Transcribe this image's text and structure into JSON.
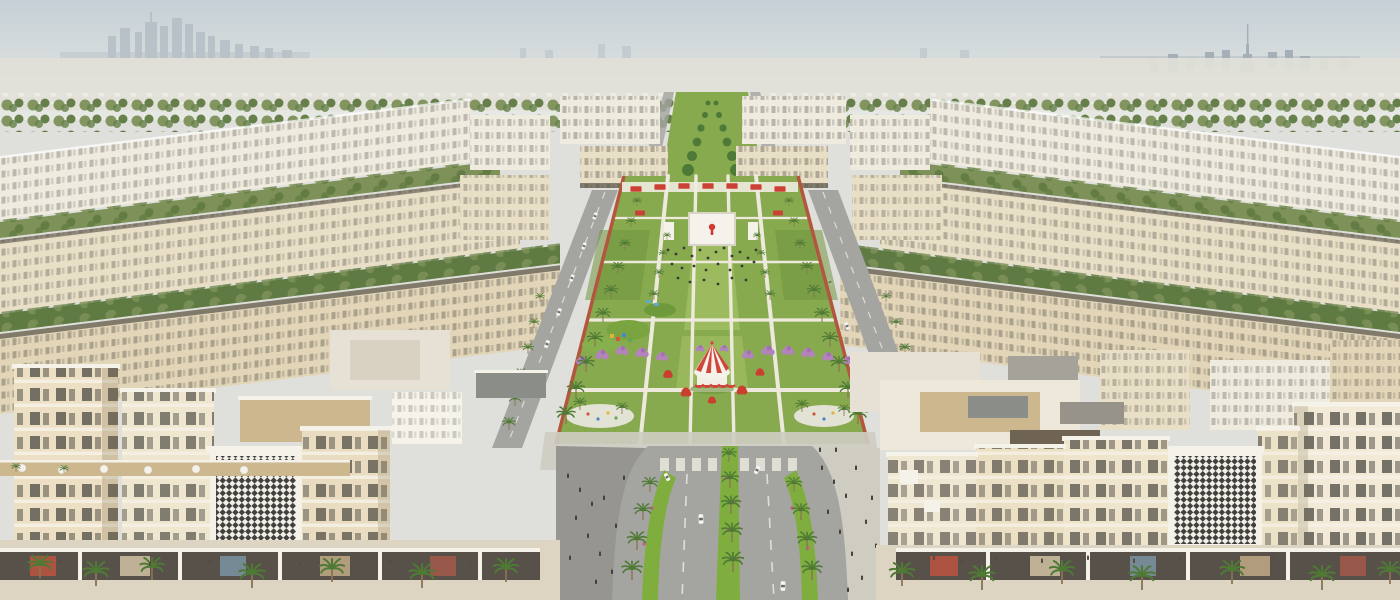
{
  "scene": {
    "description": "Aerial rendering of a symmetric master-planned desert community: cream mid-rise apartment blocks around a large central park with lawns, palm rows, a giant event screen with a red logo, a red-and-white circus tent, purple blossom groves, playgrounds, a palm-lined avenue forking at the foreground, retail podiums with black-and-white mashrabiya facade panels, and hazy city skylines with a tall spire tower on the horizon.",
    "time_of_day": "day, hazy sunlight",
    "landmarks": [
      "distant-skyline-left",
      "distant-spire-tower-right",
      "central-event-screen",
      "circus-tent",
      "purple-blossom-grove",
      "mashrabiya-facade-panels",
      "palm-lined-avenue",
      "central-park-lawns",
      "jogging-track"
    ],
    "decor": [
      {
        "symbol": "sym-palm",
        "layer": "palms-park-left",
        "items": [
          [
            566,
            424,
            1
          ],
          [
            576,
            398,
            0.95
          ],
          [
            586,
            372,
            0.9
          ],
          [
            595,
            347,
            0.85
          ],
          [
            603,
            322,
            0.8
          ],
          [
            611,
            298,
            0.74
          ],
          [
            618,
            274,
            0.68
          ],
          [
            625,
            250,
            0.6
          ],
          [
            631,
            227,
            0.54
          ],
          [
            637,
            206,
            0.48
          ]
        ]
      },
      {
        "symbol": "sym-palm",
        "layer": "palms-park-right",
        "items": [
          [
            858,
            424,
            1
          ],
          [
            848,
            398,
            0.95
          ],
          [
            839,
            372,
            0.9
          ],
          [
            830,
            347,
            0.85
          ],
          [
            822,
            322,
            0.8
          ],
          [
            814,
            298,
            0.74
          ],
          [
            807,
            274,
            0.68
          ],
          [
            800,
            250,
            0.6
          ],
          [
            794,
            227,
            0.54
          ],
          [
            789,
            206,
            0.48
          ]
        ]
      },
      {
        "symbol": "sym-palm",
        "layer": "palms-park-inner",
        "items": [
          [
            654,
            300,
            0.55
          ],
          [
            659,
            278,
            0.5
          ],
          [
            663,
            258,
            0.46
          ],
          [
            667,
            240,
            0.42
          ],
          [
            770,
            300,
            0.55
          ],
          [
            765,
            278,
            0.5
          ],
          [
            761,
            258,
            0.46
          ],
          [
            757,
            240,
            0.42
          ],
          [
            580,
            410,
            0.7
          ],
          [
            622,
            414,
            0.65
          ],
          [
            802,
            412,
            0.7
          ],
          [
            844,
            416,
            0.65
          ]
        ]
      },
      {
        "symbol": "sym-palm",
        "layer": "palms-median",
        "items": [
          [
            729,
            462,
            0.8
          ],
          [
            730,
            488,
            0.95
          ],
          [
            731,
            514,
            1.05
          ],
          [
            732,
            542,
            1.1
          ],
          [
            733,
            572,
            1.15
          ],
          [
            650,
            492,
            0.85
          ],
          [
            643,
            520,
            0.95
          ],
          [
            637,
            550,
            1.05
          ],
          [
            632,
            580,
            1.1
          ],
          [
            794,
            492,
            0.85
          ],
          [
            801,
            520,
            0.95
          ],
          [
            807,
            550,
            1.05
          ],
          [
            812,
            580,
            1.1
          ]
        ]
      },
      {
        "symbol": "sym-palm",
        "layer": "palms-street-left",
        "items": [
          [
            540,
            302,
            0.5
          ],
          [
            534,
            328,
            0.55
          ],
          [
            528,
            354,
            0.6
          ],
          [
            521,
            380,
            0.65
          ],
          [
            515,
            406,
            0.7
          ],
          [
            509,
            430,
            0.72
          ]
        ]
      },
      {
        "symbol": "sym-palm",
        "layer": "palms-street-right",
        "items": [
          [
            886,
            302,
            0.5
          ],
          [
            896,
            328,
            0.55
          ],
          [
            905,
            354,
            0.6
          ],
          [
            915,
            380,
            0.65
          ],
          [
            925,
            406,
            0.7
          ],
          [
            934,
            430,
            0.72
          ]
        ]
      },
      {
        "symbol": "sym-palm",
        "layer": "palms-front-left",
        "items": [
          [
            40,
            578,
            1.3
          ],
          [
            96,
            586,
            1.4
          ],
          [
            152,
            580,
            1.3
          ],
          [
            252,
            588,
            1.4
          ],
          [
            332,
            582,
            1.35
          ],
          [
            422,
            588,
            1.4
          ],
          [
            506,
            582,
            1.35
          ],
          [
            16,
            472,
            0.5
          ],
          [
            64,
            474,
            0.5
          ]
        ]
      },
      {
        "symbol": "sym-palm",
        "layer": "palms-front-right",
        "items": [
          [
            902,
            586,
            1.35
          ],
          [
            982,
            590,
            1.4
          ],
          [
            1062,
            584,
            1.35
          ],
          [
            1142,
            590,
            1.4
          ],
          [
            1232,
            584,
            1.35
          ],
          [
            1322,
            590,
            1.4
          ],
          [
            1390,
            584,
            1.3
          ]
        ]
      },
      {
        "symbol": "sym-tree",
        "layer": "boulevard-trees",
        "fill": "#4e7a38",
        "items": [
          [
            688,
            170,
            0.85
          ],
          [
            736,
            170,
            0.85
          ],
          [
            692,
            156,
            0.72
          ],
          [
            732,
            156,
            0.72
          ],
          [
            697,
            142,
            0.62
          ],
          [
            727,
            142,
            0.62
          ],
          [
            701,
            128,
            0.52
          ],
          [
            723,
            128,
            0.52
          ],
          [
            705,
            115,
            0.44
          ],
          [
            719,
            115,
            0.44
          ],
          [
            708,
            103,
            0.36
          ],
          [
            716,
            103,
            0.36
          ]
        ]
      },
      {
        "symbol": "sym-ptree",
        "layer": "purple-grove",
        "items": [
          [
            582,
            360,
            0.8
          ],
          [
            602,
            354,
            0.9
          ],
          [
            622,
            350,
            0.85
          ],
          [
            642,
            352,
            0.9
          ],
          [
            662,
            356,
            0.8
          ],
          [
            700,
            348,
            0.6
          ],
          [
            724,
            348,
            0.6
          ],
          [
            748,
            354,
            0.8
          ],
          [
            768,
            350,
            0.9
          ],
          [
            788,
            350,
            0.85
          ],
          [
            808,
            352,
            0.9
          ],
          [
            828,
            356,
            0.8
          ],
          [
            848,
            360,
            0.75
          ]
        ]
      },
      {
        "symbol": "sym-rtree",
        "layer": "red-grove",
        "items": [
          [
            668,
            374,
            0.8
          ],
          [
            686,
            392,
            0.9
          ],
          [
            742,
            390,
            0.9
          ],
          [
            760,
            372,
            0.75
          ],
          [
            712,
            400,
            0.7
          ]
        ]
      },
      {
        "symbol": "sym-canopy",
        "layer": "red-canopies",
        "fill": "#cc4136",
        "items": [
          [
            636,
            189,
            0.8
          ],
          [
            660,
            187,
            0.8
          ],
          [
            684,
            186,
            0.8
          ],
          [
            708,
            186,
            0.8
          ],
          [
            732,
            186,
            0.8
          ],
          [
            756,
            187,
            0.8
          ],
          [
            780,
            189,
            0.8
          ],
          [
            640,
            213,
            0.7
          ],
          [
            778,
            213,
            0.7
          ]
        ]
      },
      {
        "symbol": "sym-dot",
        "layer": "event-crowd",
        "fill": "#3c3a36",
        "items": [
          [
            668,
            250
          ],
          [
            676,
            254
          ],
          [
            684,
            248
          ],
          [
            692,
            256
          ],
          [
            700,
            250
          ],
          [
            708,
            258
          ],
          [
            716,
            252
          ],
          [
            724,
            248
          ],
          [
            732,
            256
          ],
          [
            740,
            252
          ],
          [
            748,
            258
          ],
          [
            756,
            250
          ],
          [
            672,
            264
          ],
          [
            682,
            268
          ],
          [
            694,
            266
          ],
          [
            706,
            270
          ],
          [
            718,
            264
          ],
          [
            730,
            270
          ],
          [
            742,
            266
          ],
          [
            754,
            262
          ],
          [
            678,
            278
          ],
          [
            690,
            282
          ],
          [
            704,
            280
          ],
          [
            718,
            284
          ],
          [
            732,
            278
          ],
          [
            746,
            280
          ]
        ]
      },
      {
        "symbol": "sym-person",
        "layer": "plaza-people-left",
        "fill": "#44413c",
        "items": [
          [
            568,
            478
          ],
          [
            580,
            492
          ],
          [
            592,
            506
          ],
          [
            576,
            520
          ],
          [
            588,
            538
          ],
          [
            600,
            556
          ],
          [
            612,
            574
          ],
          [
            570,
            560
          ],
          [
            604,
            500
          ],
          [
            616,
            528
          ],
          [
            624,
            480
          ],
          [
            596,
            584
          ]
        ]
      },
      {
        "symbol": "sym-person",
        "layer": "plaza-people-right",
        "fill": "#44413c",
        "items": [
          [
            822,
            470
          ],
          [
            834,
            484
          ],
          [
            846,
            498
          ],
          [
            828,
            514
          ],
          [
            840,
            534
          ],
          [
            852,
            556
          ],
          [
            862,
            580
          ],
          [
            872,
            500
          ],
          [
            856,
            470
          ],
          [
            866,
            524
          ],
          [
            876,
            548
          ],
          [
            848,
            592
          ],
          [
            820,
            452
          ],
          [
            836,
            452
          ]
        ]
      },
      {
        "symbol": "sym-person",
        "layer": "arcade-people",
        "fill": "#5a4a42",
        "items": [
          [
            906,
            562
          ],
          [
            934,
            560
          ],
          [
            962,
            564
          ],
          [
            996,
            561
          ],
          [
            1042,
            563
          ],
          [
            1088,
            560
          ],
          [
            1134,
            563
          ],
          [
            1180,
            561
          ],
          [
            1226,
            563
          ],
          [
            1272,
            560
          ],
          [
            150,
            566
          ],
          [
            210,
            564
          ],
          [
            300,
            566
          ],
          [
            390,
            564
          ],
          [
            470,
            566
          ],
          [
            60,
            564
          ]
        ]
      },
      {
        "symbol": "sym-car",
        "layer": "cars-street-left",
        "fill": "#f2f2ee",
        "items": [
          [
            595,
            216,
            0.7,
            111
          ],
          [
            584,
            246,
            0.7,
            111
          ],
          [
            572,
            278,
            0.72,
            111
          ],
          [
            559,
            312,
            0.75,
            111
          ],
          [
            547,
            344,
            0.78,
            111
          ]
        ]
      },
      {
        "symbol": "sym-car",
        "layer": "cars-street-right",
        "fill": "#f2f2ee",
        "items": [
          [
            814,
            240,
            0.7,
            69
          ],
          [
            830,
            282,
            0.72,
            69
          ],
          [
            847,
            326,
            0.75,
            69
          ]
        ]
      },
      {
        "symbol": "sym-car",
        "layer": "cars-avenue",
        "fill": "#f6f5f0",
        "items": [
          [
            701,
            519,
            0.95,
            88
          ],
          [
            783,
            586,
            0.95,
            91
          ],
          [
            667,
            477,
            0.8,
            62
          ],
          [
            757,
            470,
            0.8,
            115
          ]
        ]
      },
      {
        "symbol": "sym-umbrella",
        "layer": "terrace-umbrellas",
        "items": [
          [
            22,
            468
          ],
          [
            62,
            470
          ],
          [
            104,
            469
          ],
          [
            148,
            470
          ],
          [
            196,
            469
          ],
          [
            244,
            470
          ]
        ]
      }
    ]
  },
  "palette": {
    "skyTop": "#c6d0d6",
    "skyHorizon": "#e8e9e4",
    "skylineFar": "#b4bec5",
    "skylineNear": "#9fabb4",
    "haze": "#e0dfd8",
    "farGreen1": "#7e9159",
    "farGreen2": "#5f7a42",
    "buildingLight": "#f0ebdf",
    "buildingWhite": "#f6f3ea",
    "buildingCream": "#e9dfc6",
    "buildingCream2": "#e2d5b8",
    "buildingShadow": "#c8b998",
    "windowDark": "#55524a",
    "roofLight": "#e6e1d4",
    "roofTan": "#ccb78e",
    "roofDark": "#575249",
    "roofPanel": "#8b8d88",
    "road": "#a4a4a0",
    "roadDark": "#8f908c",
    "laneLine": "#eceade",
    "plazaLight": "#cfccc2",
    "plazaDark": "#96958f",
    "lawn": "#88aa4e",
    "lawnLight": "#9cbb5e",
    "lawnDark": "#6f9440",
    "shrub": "#7fae3e",
    "palm": "#4f7a35",
    "trunk": "#8a7355",
    "purpleTree": "#b383bb",
    "purpleTreeDark": "#9a6aa6",
    "redTree": "#c9402f",
    "tentRed": "#d0463c",
    "track": "#b2573e",
    "screenWhite": "#f4f2ea",
    "logoRed": "#d03a35",
    "flowerPink": "#cf5e8e"
  }
}
